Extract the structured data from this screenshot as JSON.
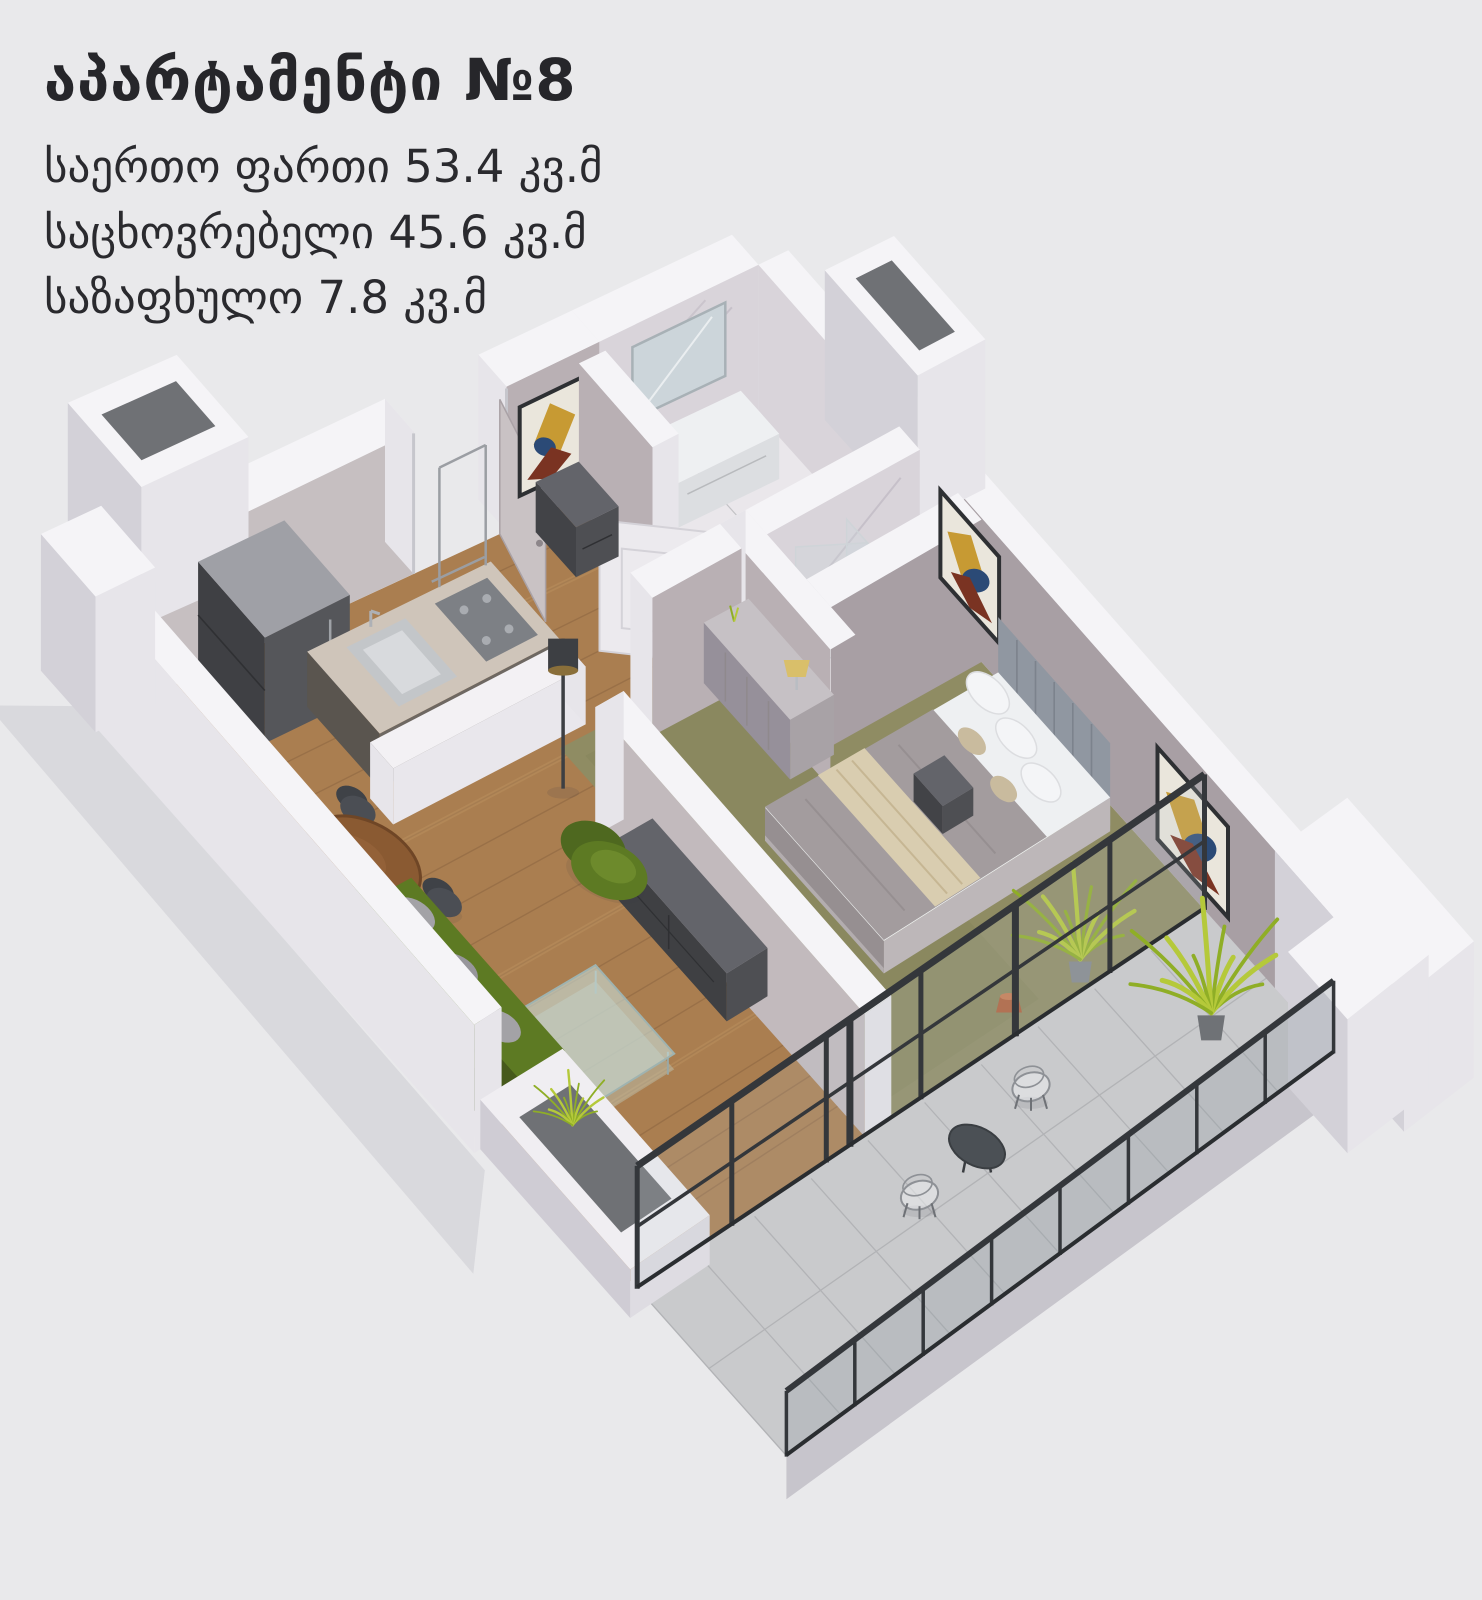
{
  "caption": {
    "title": "აპარტამენტი №8",
    "lines": [
      "საერთო ფართი 53.4 კვ.მ",
      "საცხოვრებელი 45.6 კვ.მ",
      "საზაფხულო 7.8 კვ.მ"
    ],
    "areas": {
      "total_sqm": "53.4",
      "living_sqm": "45.6",
      "summer_sqm": "7.8"
    },
    "apartment_number": "8"
  },
  "palette": {
    "background": "#e9e9eb",
    "ink": "#26262a",
    "wallTop": "#f5f4f7",
    "wallOuter": "#e7e5ea",
    "wallOuterSide": "#d3d1d8",
    "wallGreige": "#b9b0b4",
    "wallGreigeDark": "#a89fa4",
    "wallKitchen": "#c6bfc1",
    "marble": "#d9d4da",
    "marbleVein": "#b4adb9",
    "bathFloor": "#eae7eb",
    "wood": "#aa7e50",
    "woodSeam": "#8a6340",
    "woodLight": "#c9a06b",
    "carpet": "#8f8c63",
    "carpetDark": "#7c7a54",
    "tile": "#c9cacc",
    "grout": "#b2b3b6",
    "slabEdge": "#c7c5cc",
    "black": "#34373b",
    "blackDeep": "#2a2d30",
    "glass": "rgba(190,202,207,0.18)",
    "glassRail": "rgba(145,155,160,0.28)",
    "steel": "#c6c6cc",
    "fridgeTop": "#9fa0a6",
    "fridgeFront": "#55565a",
    "fridgeSide": "#3f4044",
    "counterTop": "#cfc5ba",
    "counterFront": "#6e6862",
    "counterSide": "#5a554f",
    "hob": "#7d8085",
    "hobRing": "#a9acb1",
    "sink": "#c3c6c9",
    "sinkInner": "#d8dadd",
    "furnDarkTop": "#63646a",
    "furnDark": "#4e4f53",
    "furnDarkSide": "#424347",
    "doorLeaf": "#c9c2c4",
    "doorWhite": "#eceaee",
    "headboard": "#9097a1",
    "headboardLine": "#7c838d",
    "bedSide": "#bdb7b9",
    "duvet": "#a39c9e",
    "duvetFold": "#918a8c",
    "runner": "#d9cdb0",
    "runnerLine": "#c6b693",
    "sheet": "#eef0f2",
    "pillowWhite": "#f4f5f7",
    "pillowTan": "#c9bb9e",
    "dresserTop": "#c6c1c5",
    "dresserFront": "#a8a2a6",
    "dresserSide": "#96909a",
    "lampShade": "#d9bf6a",
    "sofaGreen": "#5d7a23",
    "sofaGreenDark": "#4e681f",
    "sofaGreenDeep": "#42561a",
    "pillowGray": "#a3a2a6",
    "tableWood": "#8a5a32",
    "tableWoodEdge": "#6f4626",
    "chairDark": "#4b4e54",
    "chairDarkBack": "#3f4247",
    "glassTable": "rgba(198,220,214,0.62)",
    "glassTableEdge": "#9fb3b0",
    "plant": "#b5c93a",
    "plantDark": "#8fae26",
    "potGray": "#84888d",
    "terracotta": "#b0603a",
    "artBg": "#eae6dc",
    "artFrame": "#2e3033",
    "artGold": "#c79a33",
    "artBlue": "#2b4a76",
    "artMaroon": "#7a3322",
    "mirror": "#ccd5da",
    "mirrorEdge": "#a8b1b6",
    "holeDark": "#6f7175",
    "shadow": "rgba(110,110,125,0.12)"
  }
}
